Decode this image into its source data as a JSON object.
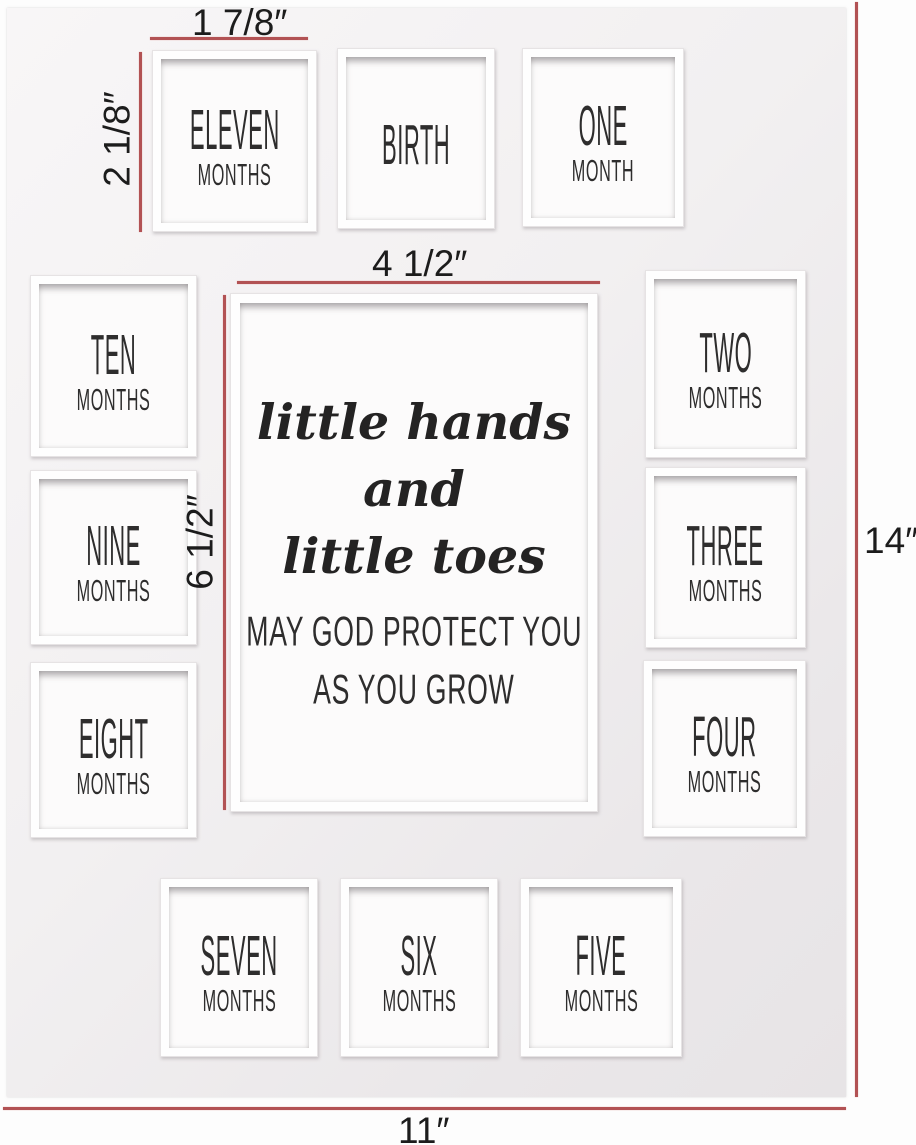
{
  "product": {
    "name": "milestone-photo-mat"
  },
  "colors": {
    "dimension_line": "#b25254",
    "mat_top": "#f8f6f7",
    "mat_bottom": "#e7e4e6",
    "label_text": "#2e2d2d"
  },
  "center": {
    "quote_lines": [
      "little hands",
      "and",
      "little toes"
    ],
    "blessing_lines": [
      "MAY GOD PROTECT YOU",
      "AS YOU GROW"
    ],
    "x": 230,
    "y": 293,
    "w": 368,
    "h": 519
  },
  "dimensions": {
    "small_opening_width": "1 7/8″",
    "small_opening_height": "2 1/8″",
    "center_opening_width": "4 1/2″",
    "center_opening_height": "6 1/2″",
    "mat_height": "14″",
    "mat_width": "11″"
  },
  "openings": [
    {
      "label": "ELEVEN",
      "sublabel": "MONTHS",
      "x": 152,
      "y": 50,
      "w": 165,
      "h": 182
    },
    {
      "label": "BIRTH",
      "sublabel": "",
      "x": 337,
      "y": 48,
      "w": 158,
      "h": 181
    },
    {
      "label": "ONE",
      "sublabel": "MONTH",
      "x": 522,
      "y": 48,
      "w": 162,
      "h": 179
    },
    {
      "label": "TEN",
      "sublabel": "MONTHS",
      "x": 30,
      "y": 275,
      "w": 167,
      "h": 182
    },
    {
      "label": "TWO",
      "sublabel": "MONTHS",
      "x": 645,
      "y": 270,
      "w": 161,
      "h": 188
    },
    {
      "label": "NINE",
      "sublabel": "MONTHS",
      "x": 30,
      "y": 470,
      "w": 167,
      "h": 175
    },
    {
      "label": "THREE",
      "sublabel": "MONTHS",
      "x": 645,
      "y": 467,
      "w": 161,
      "h": 181
    },
    {
      "label": "EIGHT",
      "sublabel": "MONTHS",
      "x": 30,
      "y": 662,
      "w": 167,
      "h": 176
    },
    {
      "label": "FOUR",
      "sublabel": "MONTHS",
      "x": 643,
      "y": 660,
      "w": 163,
      "h": 177
    },
    {
      "label": "SEVEN",
      "sublabel": "MONTHS",
      "x": 160,
      "y": 878,
      "w": 158,
      "h": 179
    },
    {
      "label": "SIX",
      "sublabel": "MONTHS",
      "x": 340,
      "y": 878,
      "w": 158,
      "h": 179
    },
    {
      "label": "FIVE",
      "sublabel": "MONTHS",
      "x": 520,
      "y": 878,
      "w": 162,
      "h": 179
    }
  ]
}
